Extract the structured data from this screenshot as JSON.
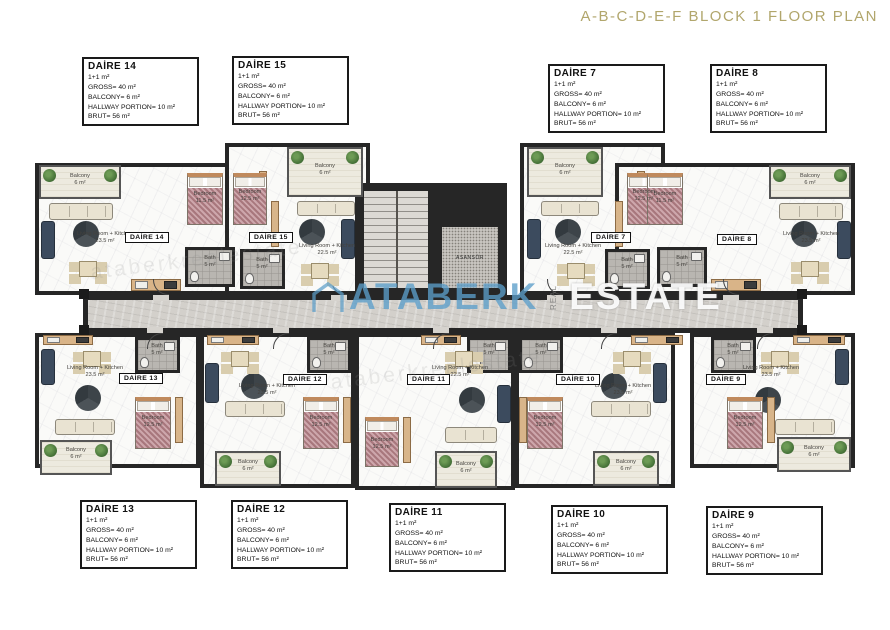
{
  "title": "A-B-C-D-E-F BLOCK 1 FLOOR PLAN",
  "watermark": {
    "brand": "ATABERK",
    "vertical": "REAL",
    "secondary": "ESTATE",
    "diagonal": "ataberkrealestate"
  },
  "specs": {
    "type": "1+1 m²",
    "gross": "GROSS= 40 m²",
    "balcony": "BALCONY= 6 m²",
    "hallway": "HALLWAY PORTION= 10 m²",
    "brut": "BRUT= 56 m²"
  },
  "info_boxes": [
    {
      "title": "DAİRE 14"
    },
    {
      "title": "DAİRE 15"
    },
    {
      "title": "DAİRE 7"
    },
    {
      "title": "DAİRE 8"
    },
    {
      "title": "DAİRE 13"
    },
    {
      "title": "DAİRE 12"
    },
    {
      "title": "DAİRE 11"
    },
    {
      "title": "DAİRE 10"
    },
    {
      "title": "DAİRE 9"
    }
  ],
  "plan": {
    "units": [
      {
        "chip": "DAİRE 14",
        "living_area": "23.5 m²",
        "bedroom_area": "11.5 m²"
      },
      {
        "chip": "DAİRE 15",
        "living_area": "22.5 m²",
        "bedroom_area": "12.5 m²"
      },
      {
        "chip": "DAİRE 7",
        "living_area": "22.5 m²",
        "bedroom_area": "12.5 m²"
      },
      {
        "chip": "DAİRE 8",
        "living_area": "23.5 m²",
        "bedroom_area": "11.5 m²"
      },
      {
        "chip": "DAİRE 13",
        "living_area": "23.5 m²",
        "bedroom_area": "12.5 m²"
      },
      {
        "chip": "DAİRE 12",
        "living_area": "23.5 m²",
        "bedroom_area": "12.5 m²"
      },
      {
        "chip": "DAİRE 11",
        "living_area": "22.5 m²",
        "bedroom_area": "12.5 m²"
      },
      {
        "chip": "DAİRE 10",
        "living_area": "23.5 m²",
        "bedroom_area": "12.5 m²"
      },
      {
        "chip": "DAİRE 9",
        "living_area": "23.5 m²",
        "bedroom_area": "12.5 m²"
      }
    ],
    "rooms": {
      "living": "Living Room + Kitchen",
      "bedroom": "Bedroom",
      "bath": "Bath",
      "bath_area": "5 m²",
      "balcony": "Balcony",
      "balcony_area": "6 m²",
      "elevator": "ASANSÖR"
    }
  },
  "colors": {
    "title_gold": "#b1a66c",
    "wall": "#262626",
    "corridor": "#d3d0cb",
    "balcony_floor": "#edeadf",
    "watermark_blue": "#5b9ec9"
  }
}
